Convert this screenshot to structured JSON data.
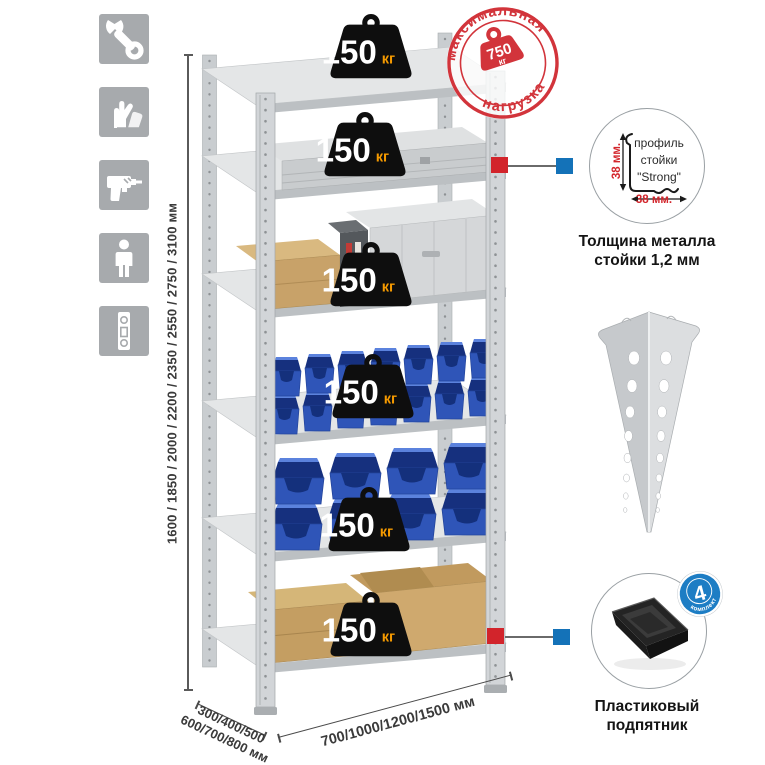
{
  "sidebar": {
    "icons": [
      {
        "name": "wrench-icon"
      },
      {
        "name": "gloves-icon"
      },
      {
        "name": "drill-icon"
      },
      {
        "name": "person-icon"
      },
      {
        "name": "level-icon"
      }
    ]
  },
  "dimensions": {
    "height": "1600 / 1850 / 2000 / 2200 / 2350 / 2550 / 2750 / 3100 мм",
    "depth_line1": "300/400/500",
    "depth_line2": "600/700/800 мм",
    "width": "700/1000/1200/1500 мм"
  },
  "stamp": {
    "arc_top": "максимальная",
    "arc_bottom": "нагрузка",
    "value": "750",
    "unit": "кг"
  },
  "badges": [
    {
      "value": "150",
      "unit": "кг"
    },
    {
      "value": "150",
      "unit": "кг"
    },
    {
      "value": "150",
      "unit": "кг"
    },
    {
      "value": "150",
      "unit": "кг"
    },
    {
      "value": "150",
      "unit": "кг"
    },
    {
      "value": "150",
      "unit": "кг"
    }
  ],
  "profile_callout": {
    "label_line1": "профиль",
    "label_line2": "стойки",
    "label_line3": "\"Strong\"",
    "dim_v": "38 мм.",
    "dim_h": "38 мм.",
    "caption1": "Толщина металла",
    "caption2": "стойки 1,2 мм"
  },
  "foot_callout": {
    "badge_value": "4",
    "badge_arc": "в комплекте",
    "caption1": "Пластиковый",
    "caption2": "подпятник"
  },
  "colors": {
    "red": "#d2242b",
    "blue": "#1472b8",
    "bin_blue": "#2f55b8",
    "unit_orange": "#f59a00",
    "icon_gray": "#a7aaad"
  }
}
